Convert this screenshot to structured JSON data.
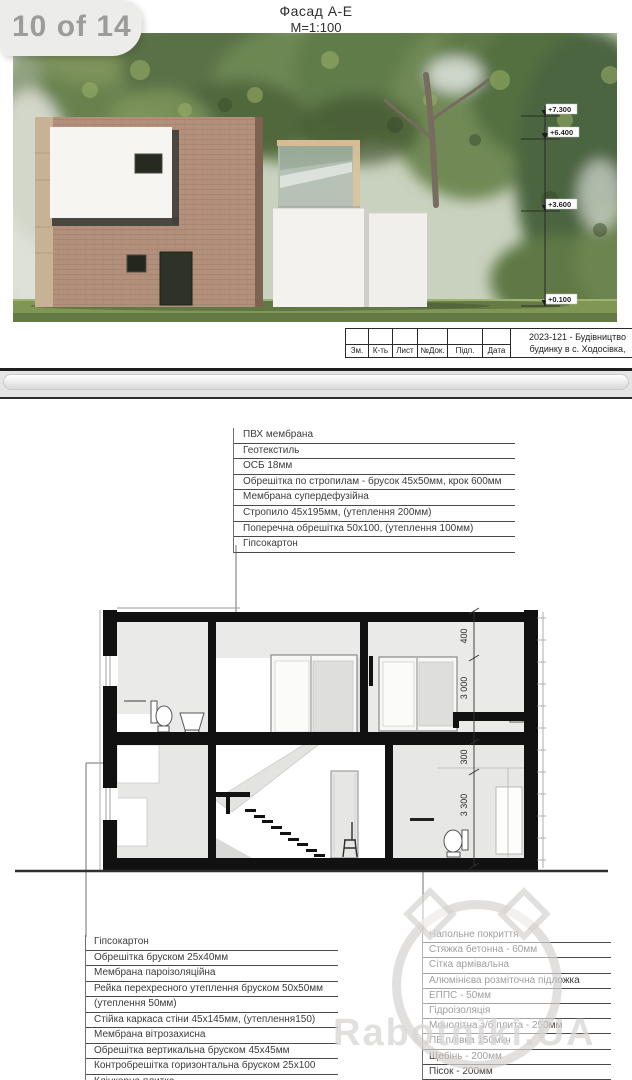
{
  "viewer": {
    "page_badge": "10 of 14"
  },
  "page1": {
    "title": "Фасад А-Е",
    "scale": "М=1:100",
    "elevations": [
      "+7.300",
      "+6.400",
      "+3.600",
      "+0.100"
    ],
    "title_block": {
      "columns": [
        "Зм.",
        "К-ть",
        "Лист",
        "№Док.",
        "Підп.",
        "Дата"
      ],
      "project_line1": "2023-121 - Будівництво",
      "project_line2": "будинку в с. Ходосівка,"
    }
  },
  "page2": {
    "roof_layers": [
      "ПВХ мембрана",
      "Геотекстиль",
      "ОСБ 18мм",
      "Обрешітка по стропилам - брусок 45х50мм, крок 600мм",
      "Мембрана супердефузійна",
      "Стропило 45х195мм, (утеплення 200мм)",
      "Поперечна обрешітка 50х100, (утеплення 100мм)",
      "Гіпсокартон"
    ],
    "wall_layers": [
      "Гіпсокартон",
      "Обрешітка бруском 25х40мм",
      "Мембрана пароізоляційна",
      "Рейка перехресного утеплення бруском 50х50мм",
      "(утеплення 50мм)",
      "Стійка каркаса стіни 45х145мм, (утеплення150)",
      "Мембрана вітрозахисна",
      "Обрешітка вертикальна бруском 45х45мм",
      "Контробрешітка горизонтальна бруском 25х100",
      "Клінкерна плитка"
    ],
    "floor_layers": [
      "Напольне покриття",
      "Стяжка бетонна - 60мм",
      "Сітка армівальна",
      "Алюмінієва розміточна підложка",
      "ЕППС - 50мм",
      "Гідроізоляція",
      "Монолітна з/б плита - 250мм",
      "ПЕ плівка 150мкн",
      "Щебінь - 200мм",
      "Пісок - 200мм"
    ],
    "dimensions": [
      "400",
      "3 000",
      "300",
      "3 300"
    ],
    "watermark": "Rabotniki.UA"
  }
}
